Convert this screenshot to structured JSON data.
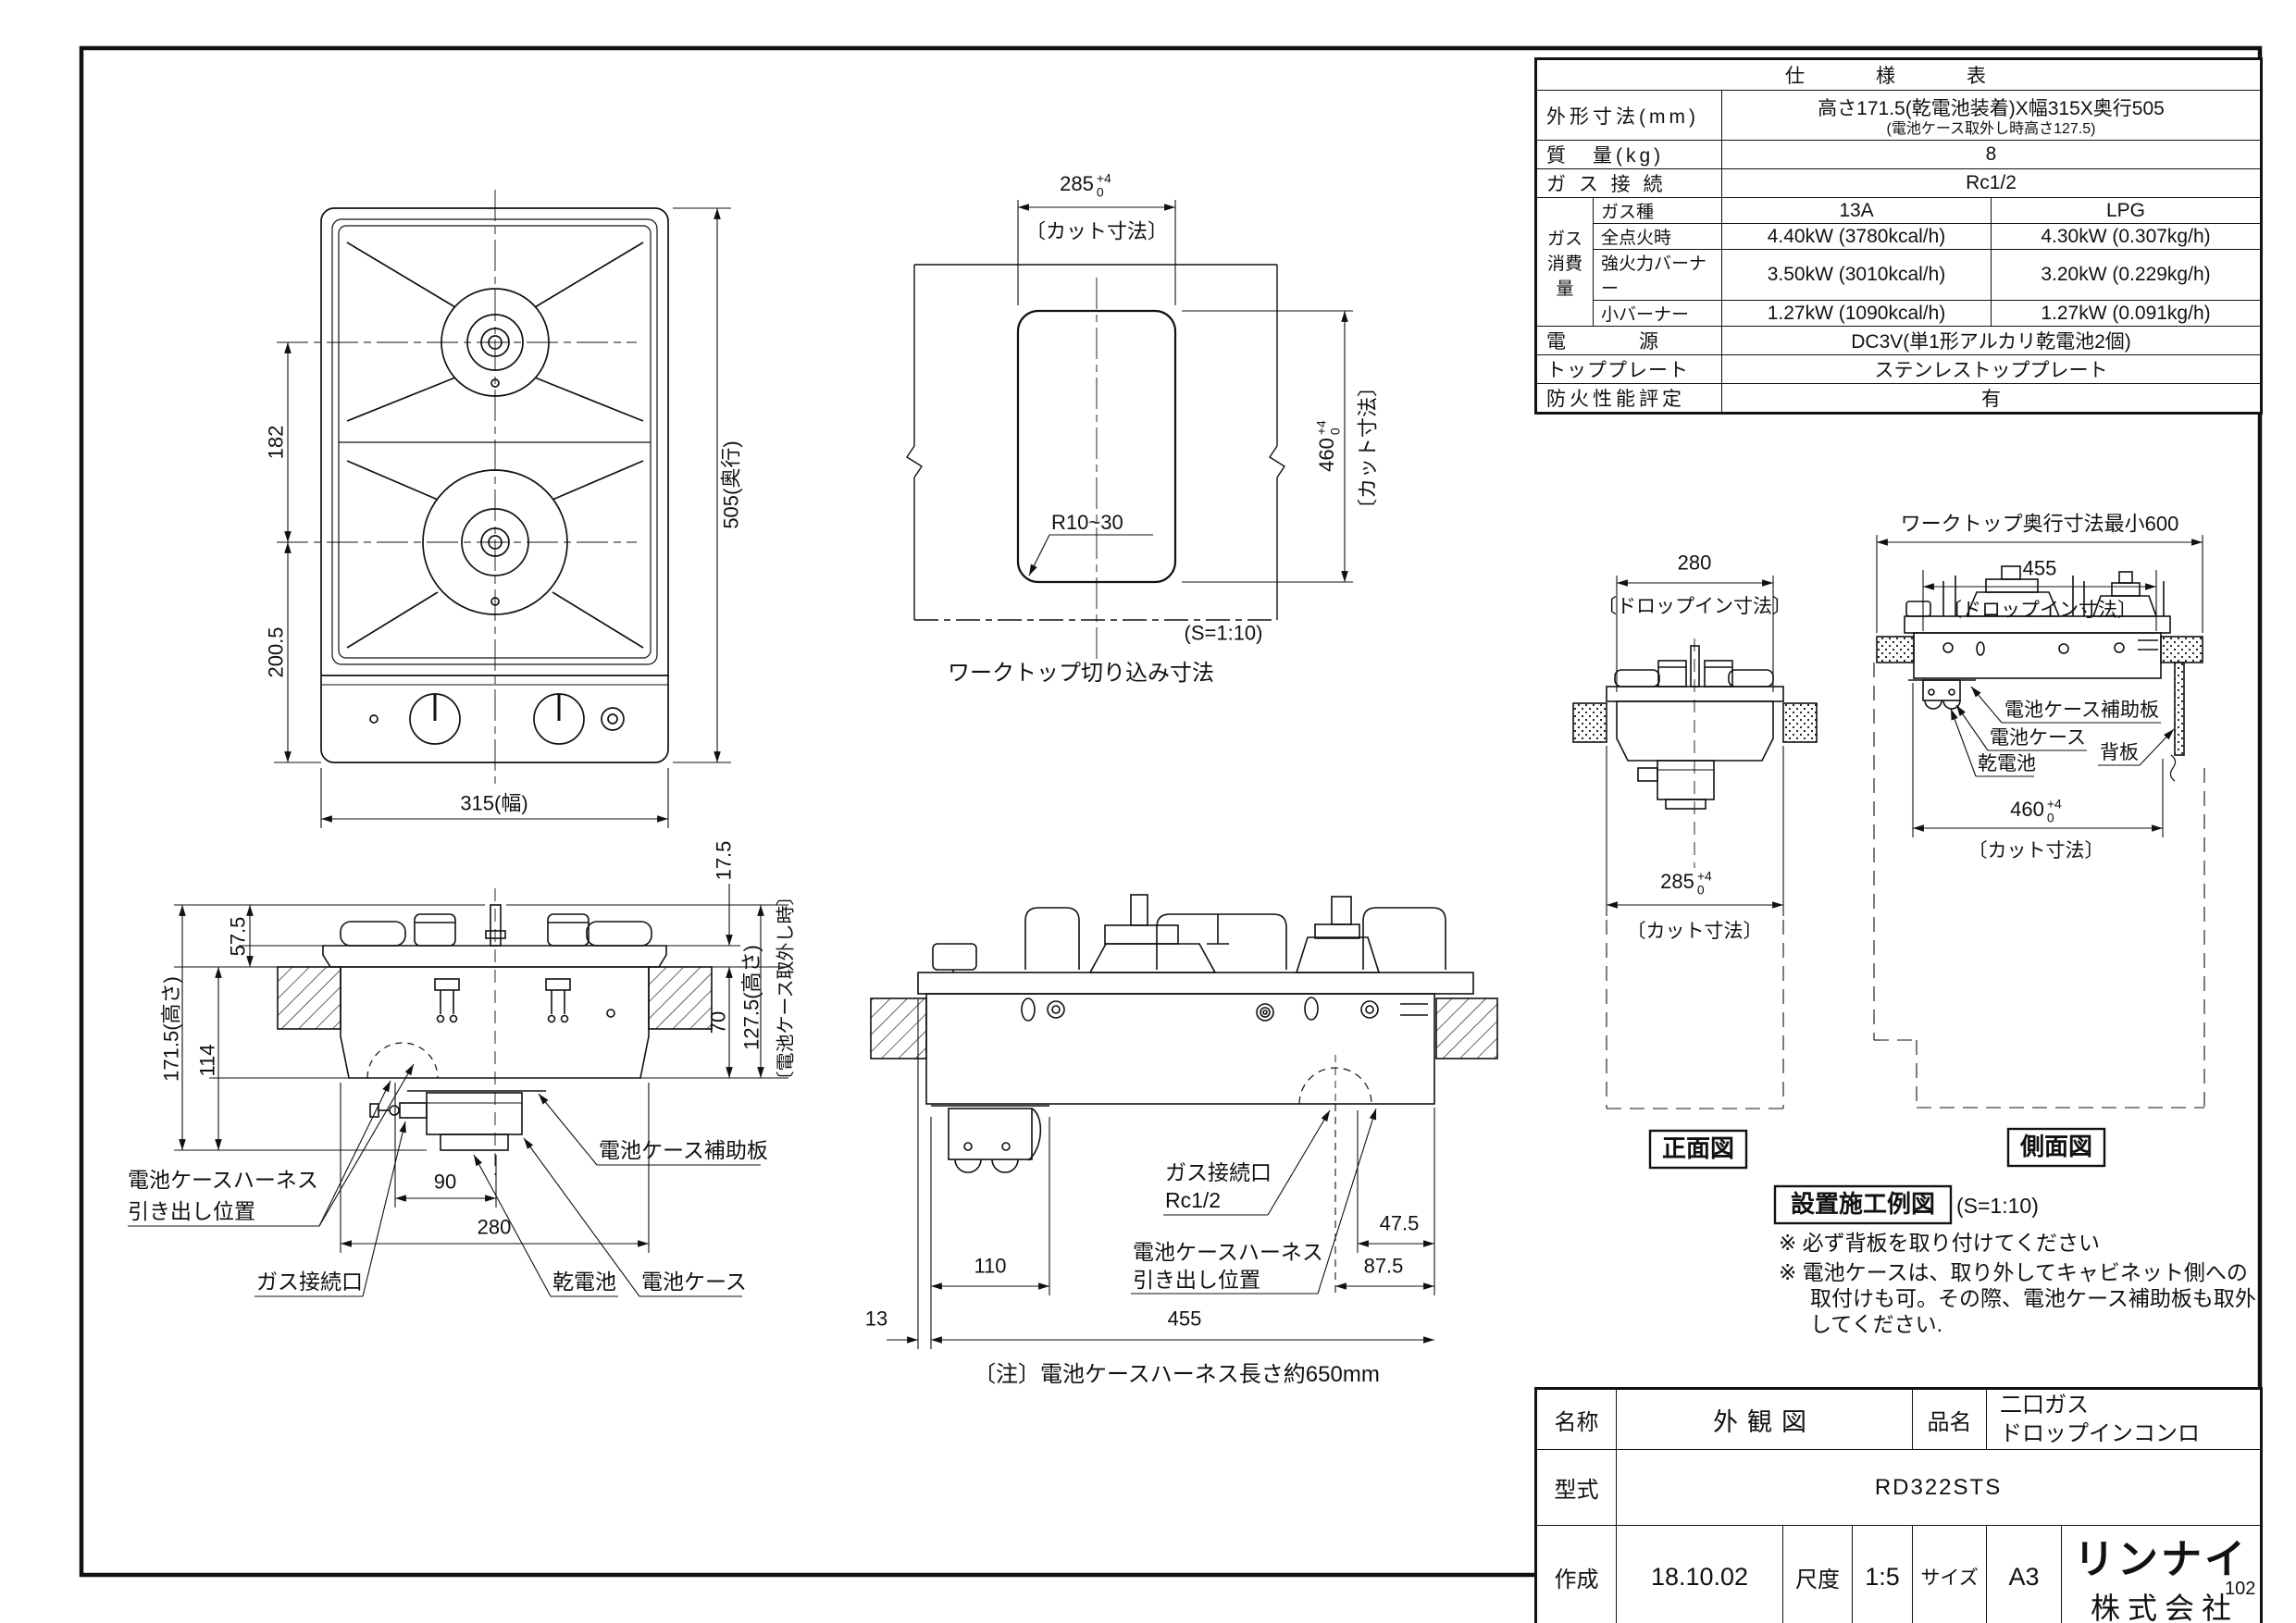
{
  "page": {
    "number": "102"
  },
  "spec_table": {
    "title": "仕　様　表",
    "outer_dim_label": "外形寸法(mm)",
    "outer_dim_value": "高さ171.5(乾電池装着)X幅315X奥行505",
    "outer_dim_note": "(電池ケース取外し時高さ127.5)",
    "weight_label": "質　量(kg)",
    "weight_value": "8",
    "gas_conn_label": "ガ ス 接 続",
    "gas_conn_value": "Rc1/2",
    "consumption_label_1": "ガス",
    "consumption_label_2": "消費量",
    "gas_type_label": "ガス種",
    "gas_type_13a": "13A",
    "gas_type_lpg": "LPG",
    "rows": [
      {
        "label": "全点火時",
        "v13a": "4.40kW (3780kcal/h)",
        "vlpg": "4.30kW (0.307kg/h)"
      },
      {
        "label": "強火力バーナー",
        "v13a": "3.50kW (3010kcal/h)",
        "vlpg": "3.20kW (0.229kg/h)"
      },
      {
        "label": "小バーナー",
        "v13a": "1.27kW (1090kcal/h)",
        "vlpg": "1.27kW (0.091kg/h)"
      }
    ],
    "power_label": "電　　　源",
    "power_value": "DC3V(単1形アルカリ乾電池2個)",
    "top_plate_label": "トッププレート",
    "top_plate_value": "ステンレストッププレート",
    "fire_rating_label": "防火性能評定",
    "fire_rating_value": "有"
  },
  "plan": {
    "dim_depth": "505(奥行)",
    "dim_width": "315(幅)",
    "dim_pitch": "182",
    "dim_front": "200.5"
  },
  "cutout": {
    "dim_w": "285",
    "dim_w_tol_p": "+4",
    "dim_w_tol_m": "0",
    "dim_w_note": "〔カット寸法〕",
    "dim_h": "460",
    "dim_h_tol_p": "+4",
    "dim_h_tol_m": "0",
    "dim_h_note": "〔カット寸法〕",
    "radius": "R10~30",
    "scale": "(S=1:10)",
    "caption": "ワークトップ切り込み寸法"
  },
  "front_elev": {
    "dim_top": "57.5",
    "dim_total_h": "171.5(高さ)",
    "dim_under": "114",
    "dim_plate": "17.5",
    "dim_body": "70",
    "dim_removed": "127.5(高さ)",
    "dim_removed_note": "〔電池ケース取外し時〕",
    "dim_90": "90",
    "dim_280": "280",
    "label_harness_1": "電池ケースハーネス",
    "label_harness_2": "引き出し位置",
    "label_gas": "ガス接続口",
    "label_battery": "乾電池",
    "label_case": "電池ケース",
    "label_aux": "電池ケース補助板"
  },
  "side_elev": {
    "dim_110": "110",
    "dim_13": "13",
    "dim_455": "455",
    "dim_475": "47.5",
    "dim_875": "87.5",
    "label_gas_1": "ガス接続口",
    "label_gas_2": "Rc1/2",
    "label_harness_1": "電池ケースハーネス",
    "label_harness_2": "引き出し位置",
    "note": "〔注〕電池ケースハーネス長さ約650mm"
  },
  "install": {
    "front": {
      "dim_280": "280",
      "dim_280_note": "〔ドロップイン寸法〕",
      "dim_285": "285",
      "tol_p": "+4",
      "tol_m": "0",
      "dim_285_note": "〔カット寸法〕",
      "caption": "正面図"
    },
    "side": {
      "dim_600": "ワークトップ奥行寸法最小600",
      "dim_455": "455",
      "dim_455_note": "〔ドロップイン寸法〕",
      "dim_460": "460",
      "tol_p": "+4",
      "tol_m": "0",
      "dim_460_note": "〔カット寸法〕",
      "caption": "側面図",
      "label_aux": "電池ケース補助板",
      "label_case": "電池ケース",
      "label_battery": "乾電池",
      "label_back": "背板"
    },
    "example": {
      "title": "設置施工例図",
      "scale": "(S=1:10)",
      "note1": "※ 必ず背板を取り付けてください",
      "note2": "※ 電池ケースは、取り外してキャビネット側への",
      "note3": "取付けも可。その際、電池ケース補助板も取外",
      "note4": "してください."
    }
  },
  "title_block": {
    "name_label": "名称",
    "name_value": "外観図",
    "product_label": "品名",
    "product_value_1": "二口ガス",
    "product_value_2": "ドロップインコンロ",
    "model_label": "型式",
    "model_value": "RD322STS",
    "date_label": "作成",
    "date_value": "18.10.02",
    "scale_label": "尺度",
    "scale_value": "1:5",
    "size_label": "サイズ",
    "size_value": "A3",
    "company_logo": "リンナイ",
    "company_suffix": "株式会社"
  }
}
